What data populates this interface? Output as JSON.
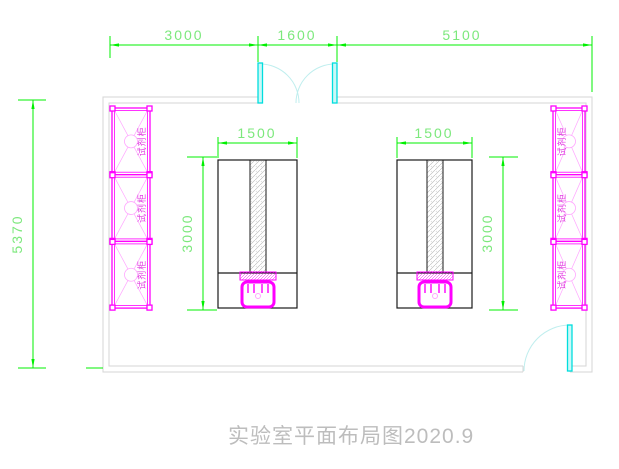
{
  "drawing": {
    "title": "实验室平面布局图2020.9",
    "colors": {
      "dimension_green": "#00f000",
      "dimension_text_green": "#7ce87c",
      "cabinet_magenta": "#ff00ff",
      "cabinet_pale_magenta": "#ffa6ff",
      "cabinet_text_magenta": "#e040e0",
      "door_cyan": "#00dede",
      "door_arc_cyan": "#bfeeee",
      "wall_gray": "#d5d5d5",
      "bench_black": "#1a1a1a",
      "title_gray": "#bdbdbd"
    },
    "dims": {
      "top_left": "3000",
      "top_mid": "1600",
      "top_right": "5100",
      "wall_left_height": "5370",
      "bench_left_width": "1500",
      "bench_left_depth": "3000",
      "bench_right_width": "1500",
      "bench_right_depth": "3000"
    },
    "cabinets": {
      "left": [
        {
          "label": "试剂柜"
        },
        {
          "label": "试剂柜"
        },
        {
          "label": "试剂柜"
        }
      ],
      "right": [
        {
          "label": "试剂柜"
        },
        {
          "label": "试剂柜"
        },
        {
          "label": "试剂柜"
        }
      ]
    }
  }
}
